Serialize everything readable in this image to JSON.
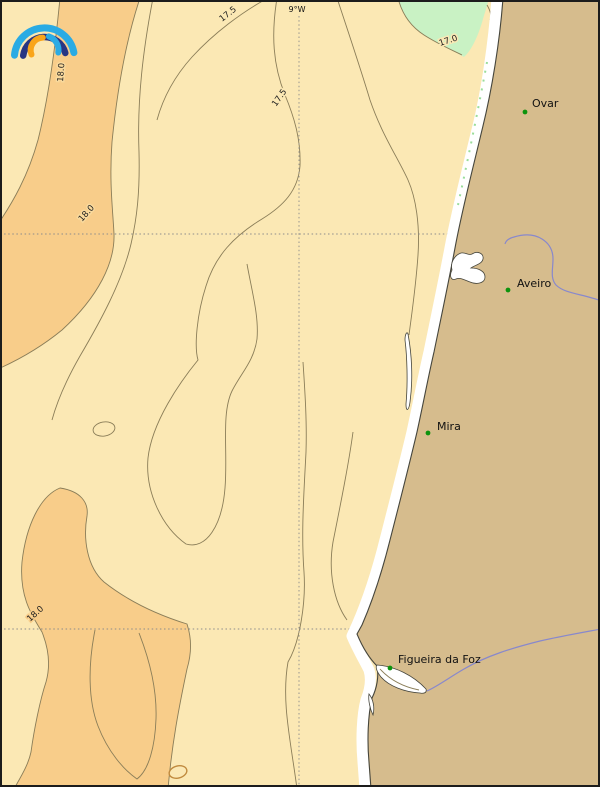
{
  "map": {
    "description": "coastal temperature contour map of central Portugal shoreline",
    "meridian_label": "9°W",
    "contour_values_visible": [
      "17.0",
      "17.5",
      "18.0"
    ],
    "contour_labels": [
      {
        "text": "17.5"
      },
      {
        "text": "17.5"
      },
      {
        "text": "17.0"
      },
      {
        "text": "18.0"
      },
      {
        "text": "18.0"
      },
      {
        "text": "18.0"
      }
    ],
    "cities": [
      {
        "name": "Ovar"
      },
      {
        "name": "Aveiro"
      },
      {
        "name": "Mira"
      },
      {
        "name": "Figueira da Foz"
      }
    ],
    "colors": {
      "sea_background": "#fbe8b4",
      "warm_band_orange": "#f8cd8a",
      "cool_patch_green": "#c9f2c4",
      "land_tan": "#d6bc8d",
      "beach_white": "#ffffff",
      "contour_line": "#8a7d58",
      "gridline_gray": "#8c8c8c",
      "river_blue": "#8888cc",
      "city_marker_green": "#0d930d",
      "frame_black": "#1c1c1c"
    },
    "logo": {
      "name": "rainbow-arcs-weather-logo",
      "arc_colors": [
        "#2aabe4",
        "#283583",
        "#f9a51a",
        "#2aabe4"
      ]
    }
  }
}
